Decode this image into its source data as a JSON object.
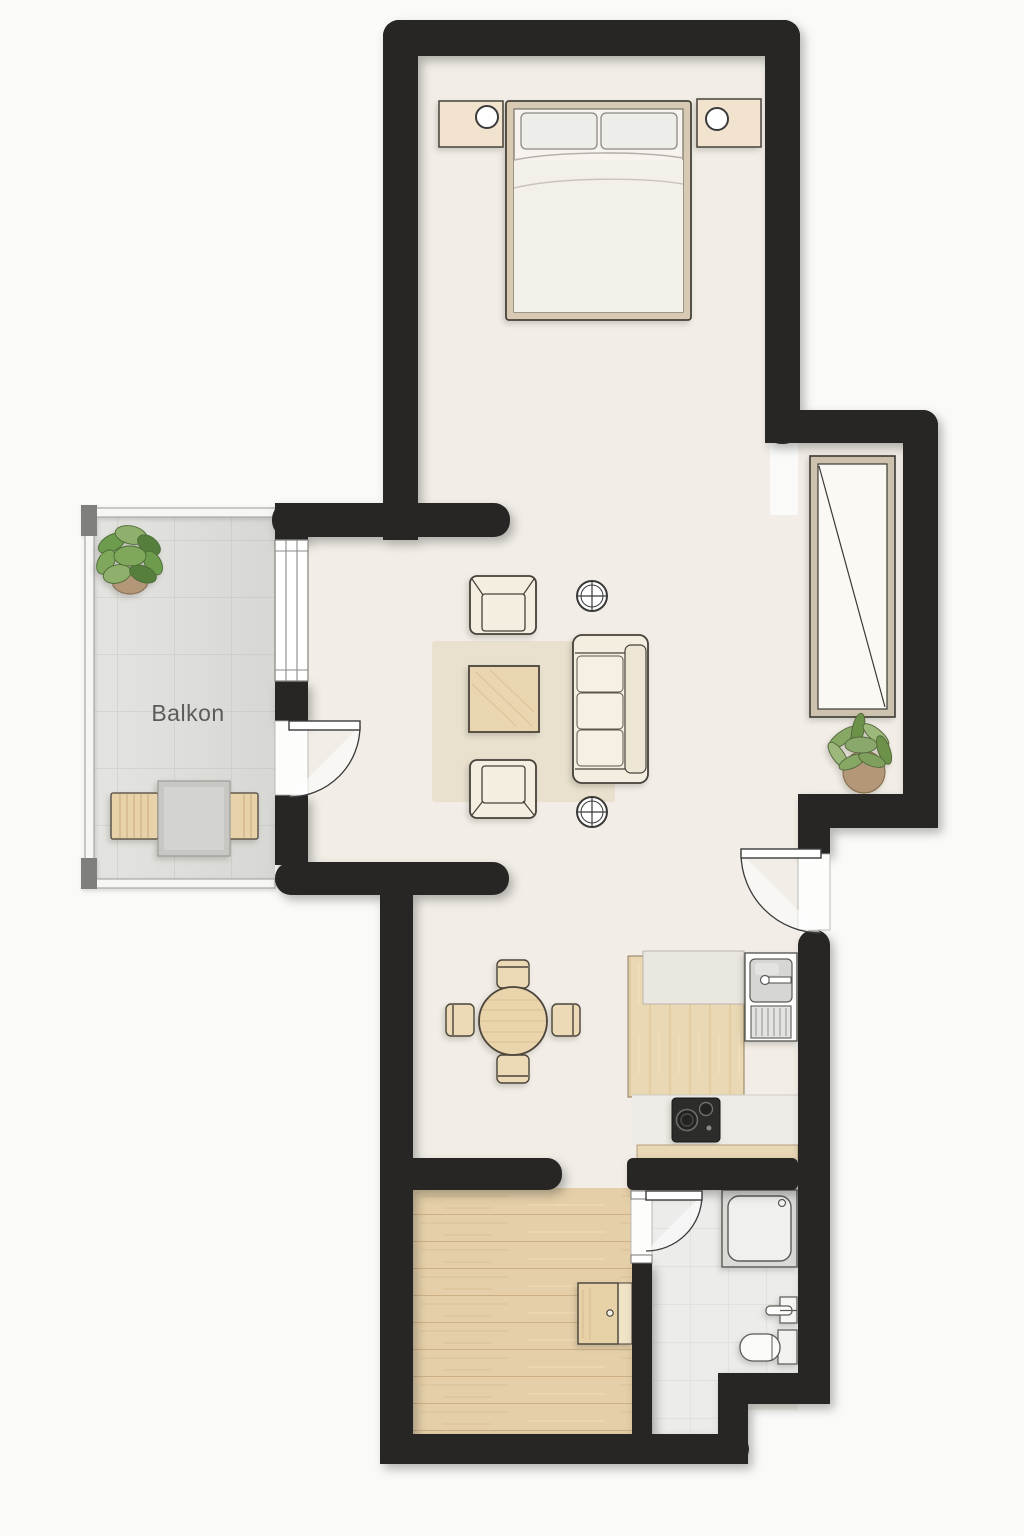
{
  "floorplan": {
    "balcony_label": "Balkon",
    "palette": {
      "wall": "#272624",
      "floor": "#f2eee7",
      "outside": "#fafaf8",
      "balcony_tile": "#e4e4e1",
      "balcony_tile_line": "#cfcfcb",
      "bath_tile": "#ececea",
      "bath_tile_line": "#dbdbd8",
      "wood_floor": "#e5cfa8",
      "wood_floor_line": "#cdb185",
      "counter_wood": "#ead7b3",
      "furniture_cream": "#f4eee1",
      "furniture_wood": "#e9d6b0",
      "rug": "#e9e1ce",
      "outline": "#45413a",
      "fixture_outline": "#5a5a56",
      "plant_green": "#6e9c4e",
      "plant_green_dark": "#567f3e",
      "plant_green_light": "#8fb06c",
      "pot": "#b29878",
      "appliance_dark": "#2c2c2a",
      "label": "#5b5b5b",
      "door_leaf": "#ffffff"
    },
    "symbols": [
      "double-bed",
      "pillow",
      "nightstand",
      "table-lamp",
      "wardrobe",
      "potted-plant",
      "armchair",
      "sofa",
      "coffee-table",
      "rug",
      "ceiling-light",
      "round-dining-table",
      "dining-chair",
      "kitchen-counter",
      "kitchen-sink",
      "drainboard",
      "cooktop",
      "balcony-table",
      "balcony-chair",
      "shower",
      "washbasin",
      "toilet",
      "cabinet",
      "door-swing",
      "window",
      "wall"
    ]
  }
}
